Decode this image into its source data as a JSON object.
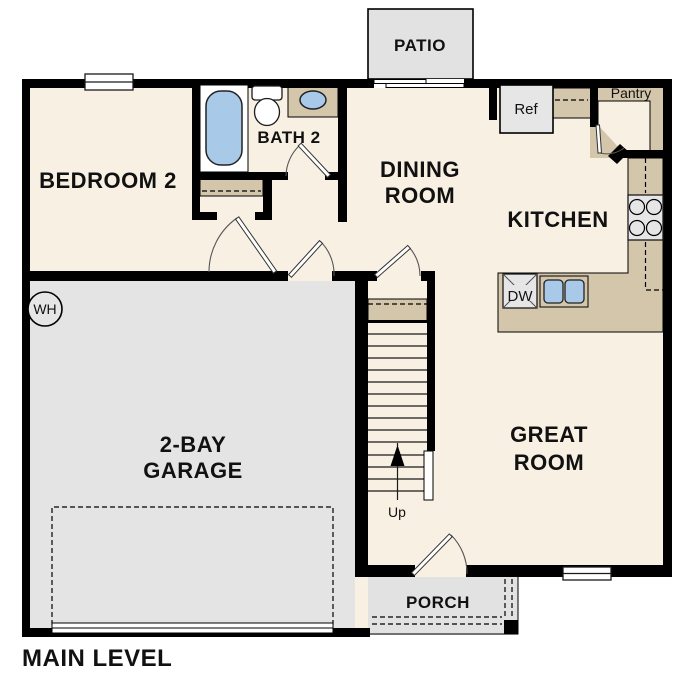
{
  "plan": {
    "title": "MAIN LEVEL",
    "rooms": {
      "bedroom2": "BEDROOM 2",
      "bath2": "BATH 2",
      "dining1": "DINING",
      "dining2": "ROOM",
      "kitchen": "KITCHEN",
      "great1": "GREAT",
      "great2": "ROOM",
      "garage1": "2-BAY",
      "garage2": "GARAGE"
    },
    "outdoor": {
      "patio": "PATIO",
      "porch": "PORCH"
    },
    "features": {
      "pantry": "Pantry",
      "ref": "Ref",
      "dw": "DW",
      "wh": "WH",
      "up": "Up"
    },
    "colors": {
      "wall": "#000000",
      "floor": "#f8f0e3",
      "garage": "#e4e4e4",
      "outdoor": "#e2e2e2",
      "counter": "#d3c6ab",
      "appliance": "#e6e6e6",
      "fixture_blue": "#a8c9e8",
      "fixture_white": "#ffffff"
    }
  }
}
